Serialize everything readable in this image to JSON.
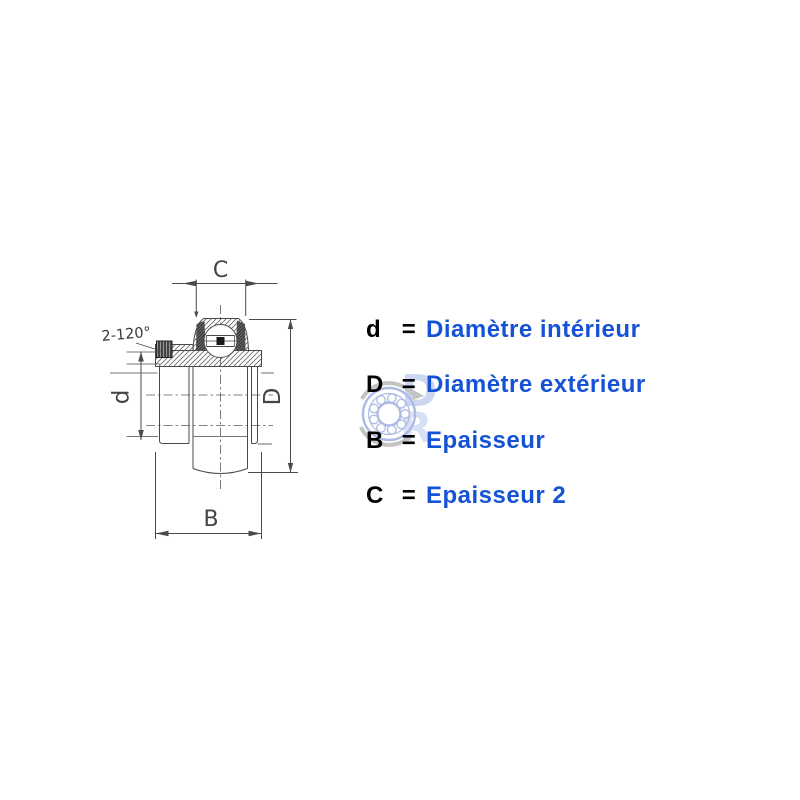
{
  "page": {
    "background": "#ffffff"
  },
  "legend": {
    "items": [
      {
        "symbol": "d",
        "equals": "=",
        "label": "Diamètre intérieur"
      },
      {
        "symbol": "D",
        "equals": "=",
        "label": "Diamètre extérieur"
      },
      {
        "symbol": "B",
        "equals": "=",
        "label": "Epaisseur"
      },
      {
        "symbol": "C",
        "equals": "=",
        "label": "Epaisseur 2"
      }
    ],
    "symbol_color": "#000000",
    "label_color": "#1552d6"
  },
  "drawing": {
    "subject": "insert bearing cross-section side view",
    "dimension_labels": {
      "top": "C",
      "right": "D",
      "bottom": "B",
      "left": "d"
    },
    "annotation": "2-120°",
    "line_color": "#4a4a4a"
  },
  "watermark": {
    "letters": [
      "D",
      "R"
    ],
    "ring_color": "#9fb0e0",
    "arrow_color": "#b9b9b9",
    "letter_color": "#bcc8ee"
  }
}
